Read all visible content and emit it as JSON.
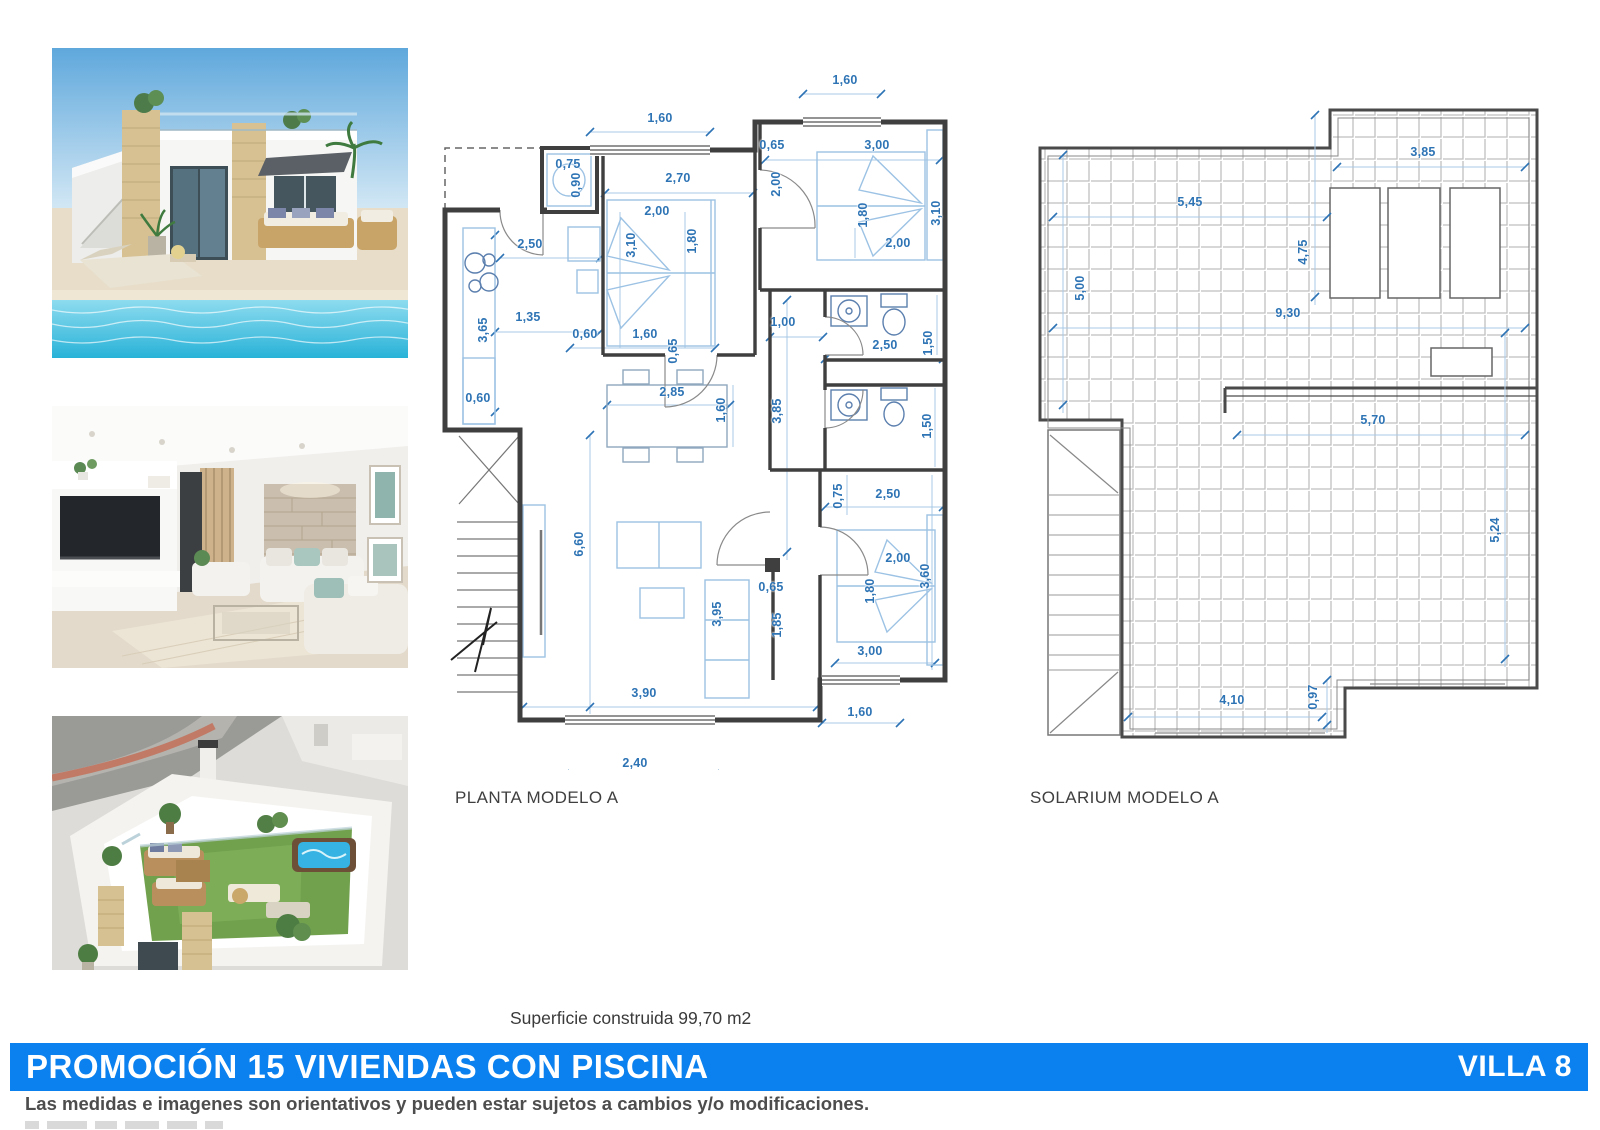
{
  "plans": {
    "planta": {
      "label": "PLANTA MODELO A",
      "dims": [
        {
          "t": "1,60",
          "x": 225,
          "y": 58
        },
        {
          "t": "1,60",
          "x": 410,
          "y": 20
        },
        {
          "t": "0,75",
          "x": 133,
          "y": 104
        },
        {
          "t": "0,90",
          "x": 141,
          "y": 125,
          "r": 1
        },
        {
          "t": "2,70",
          "x": 243,
          "y": 118
        },
        {
          "t": "0,65",
          "x": 337,
          "y": 85
        },
        {
          "t": "3,00",
          "x": 442,
          "y": 85
        },
        {
          "t": "2,00",
          "x": 341,
          "y": 124,
          "r": 1
        },
        {
          "t": "2,00",
          "x": 222,
          "y": 151
        },
        {
          "t": "3,10",
          "x": 196,
          "y": 185,
          "r": 1
        },
        {
          "t": "1,80",
          "x": 257,
          "y": 181,
          "r": 1
        },
        {
          "t": "1,80",
          "x": 428,
          "y": 155,
          "r": 1
        },
        {
          "t": "3,10",
          "x": 501,
          "y": 153,
          "r": 1
        },
        {
          "t": "2,00",
          "x": 463,
          "y": 183
        },
        {
          "t": "2,50",
          "x": 95,
          "y": 184
        },
        {
          "t": "1,35",
          "x": 93,
          "y": 257
        },
        {
          "t": "3,65",
          "x": 48,
          "y": 270,
          "r": 1
        },
        {
          "t": "0,60",
          "x": 150,
          "y": 274
        },
        {
          "t": "1,60",
          "x": 210,
          "y": 274
        },
        {
          "t": "0,65",
          "x": 238,
          "y": 291,
          "r": 1
        },
        {
          "t": "1,00",
          "x": 348,
          "y": 262
        },
        {
          "t": "2,50",
          "x": 450,
          "y": 285
        },
        {
          "t": "1,50",
          "x": 493,
          "y": 283,
          "r": 1
        },
        {
          "t": "0,60",
          "x": 43,
          "y": 338
        },
        {
          "t": "2,85",
          "x": 237,
          "y": 332
        },
        {
          "t": "1,60",
          "x": 286,
          "y": 350,
          "r": 1
        },
        {
          "t": "3,85",
          "x": 342,
          "y": 351,
          "r": 1
        },
        {
          "t": "0,75",
          "x": 403,
          "y": 436,
          "r": 1
        },
        {
          "t": "2,50",
          "x": 453,
          "y": 434
        },
        {
          "t": "1,50",
          "x": 492,
          "y": 366,
          "r": 1
        },
        {
          "t": "6,60",
          "x": 144,
          "y": 484,
          "r": 1
        },
        {
          "t": "2,00",
          "x": 463,
          "y": 498
        },
        {
          "t": "3,60",
          "x": 490,
          "y": 516,
          "r": 1
        },
        {
          "t": "1,80",
          "x": 435,
          "y": 531,
          "r": 1
        },
        {
          "t": "0,65",
          "x": 336,
          "y": 527
        },
        {
          "t": "3,95",
          "x": 282,
          "y": 554,
          "r": 1
        },
        {
          "t": "1,85",
          "x": 342,
          "y": 565,
          "r": 1
        },
        {
          "t": "3,00",
          "x": 435,
          "y": 591
        },
        {
          "t": "3,90",
          "x": 209,
          "y": 633
        },
        {
          "t": "1,60",
          "x": 425,
          "y": 652
        },
        {
          "t": "2,40",
          "x": 200,
          "y": 703
        }
      ]
    },
    "solarium": {
      "label": "SOLARIUM MODELO A",
      "dims": [
        {
          "t": "3,85",
          "x": 398,
          "y": 57
        },
        {
          "t": "5,45",
          "x": 165,
          "y": 107
        },
        {
          "t": "5,00",
          "x": 55,
          "y": 193,
          "r": 1
        },
        {
          "t": "4,75",
          "x": 278,
          "y": 157,
          "r": 1
        },
        {
          "t": "9,30",
          "x": 263,
          "y": 218
        },
        {
          "t": "5,70",
          "x": 348,
          "y": 325
        },
        {
          "t": "5,24",
          "x": 470,
          "y": 435,
          "r": 1
        },
        {
          "t": "4,10",
          "x": 207,
          "y": 605
        },
        {
          "t": "0,97",
          "x": 288,
          "y": 602,
          "r": 1
        }
      ]
    }
  },
  "footer": {
    "area_note": "Superficie construida 99,70 m2",
    "banner_left": "PROMOCIÓN 15 VIVIENDAS CON PISCINA",
    "banner_right": "VILLA 8",
    "disclaimer": "Las medidas e imagenes son orientativos y pueden estar sujetos a cambios y/o modificaciones.",
    "banner_color": "#0a81ee",
    "dim_color": "#2e74b5"
  }
}
